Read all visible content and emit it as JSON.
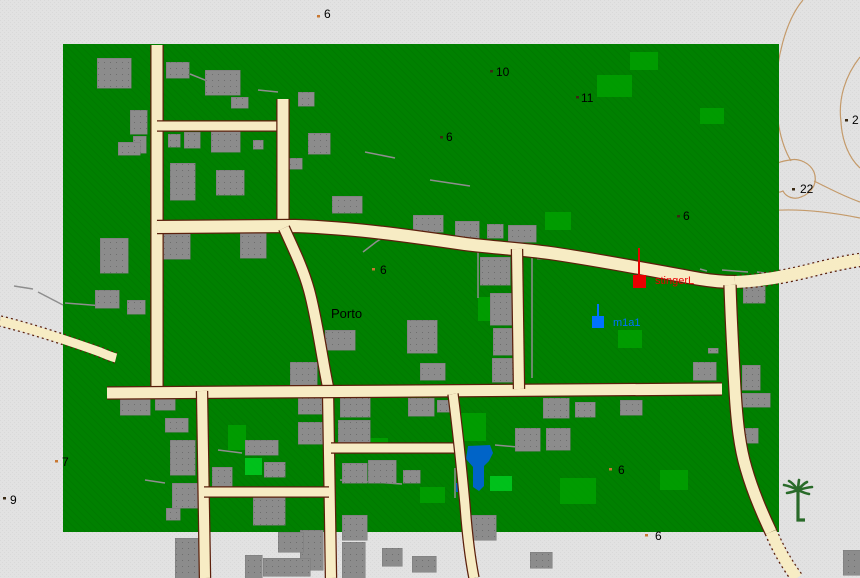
{
  "map": {
    "title": "editor-map-view",
    "outside_color": "#e2e2e2",
    "outside_dither": "#d9d9d9",
    "land_color": "#008000",
    "land_hatch": "#007a00",
    "land_rect": {
      "x": 63,
      "y": 44,
      "w": 716,
      "h": 488
    },
    "road_fill": "#f7ecc4",
    "road_edge": "#5c200c",
    "building_color": "#8c8c8c",
    "building_dot": "#6e6e6e",
    "contour_color": "#c49a6a",
    "water_color": "#0064c8",
    "fence_color": "#8e8e8e",
    "light_green": "#009e00",
    "bright_green": "#00c81e",
    "palm_color": "#2a6b2a",
    "dot_tan": "#c87832",
    "dot_dark": "#3a2a14"
  },
  "labels": [
    {
      "kind": "spot-height",
      "text": "6",
      "x": 324,
      "y": 18,
      "dot": {
        "x": 317,
        "y": 15,
        "c": "tan"
      }
    },
    {
      "kind": "spot-height",
      "text": "10",
      "x": 496,
      "y": 76,
      "dot": {
        "x": 490,
        "y": 70,
        "c": "dark"
      }
    },
    {
      "kind": "spot-height",
      "text": "11",
      "x": 581,
      "y": 102,
      "dot": {
        "x": 576,
        "y": 96,
        "c": "dark"
      }
    },
    {
      "kind": "spot-height",
      "text": "6",
      "x": 446,
      "y": 141,
      "dot": {
        "x": 440,
        "y": 136,
        "c": "dark"
      }
    },
    {
      "kind": "spot-height",
      "text": "6",
      "x": 683,
      "y": 220,
      "dot": {
        "x": 677,
        "y": 215,
        "c": "dark"
      }
    },
    {
      "kind": "spot-height",
      "text": "6",
      "x": 380,
      "y": 274,
      "dot": {
        "x": 372,
        "y": 268,
        "c": "tan"
      }
    },
    {
      "kind": "town",
      "text": "Porto",
      "x": 331,
      "y": 318
    },
    {
      "kind": "spot-height",
      "text": "2",
      "x": 852,
      "y": 124,
      "dot": {
        "x": 845,
        "y": 119,
        "c": "dark"
      }
    },
    {
      "kind": "spot-height",
      "text": "22",
      "x": 800,
      "y": 193,
      "dot": {
        "x": 792,
        "y": 188,
        "c": "dark"
      }
    },
    {
      "kind": "spot-height",
      "text": "7",
      "x": 62,
      "y": 466,
      "dot": {
        "x": 55,
        "y": 460,
        "c": "tan"
      }
    },
    {
      "kind": "spot-height",
      "text": "9",
      "x": 10,
      "y": 504,
      "dot": {
        "x": 3,
        "y": 497,
        "c": "dark"
      }
    },
    {
      "kind": "spot-height",
      "text": "6",
      "x": 618,
      "y": 474,
      "dot": {
        "x": 609,
        "y": 468,
        "c": "tan"
      }
    },
    {
      "kind": "spot-height",
      "text": "6",
      "x": 655,
      "y": 540,
      "dot": {
        "x": 645,
        "y": 534,
        "c": "tan"
      }
    }
  ],
  "markers": [
    {
      "name": "stingerL",
      "color": "#e80000",
      "square": {
        "x": 633,
        "y": 275,
        "w": 13,
        "h": 13
      },
      "line": {
        "x": 639,
        "y1": 248,
        "y2": 275
      },
      "text_x": 655,
      "text_y": 284
    },
    {
      "name": "m1a1",
      "color": "#0072ff",
      "square": {
        "x": 592,
        "y": 316,
        "w": 12,
        "h": 12
      },
      "line": {
        "x": 598,
        "y1": 304,
        "y2": 316
      },
      "text_x": 613,
      "text_y": 326
    }
  ],
  "roads": [
    {
      "name": "road-entry-west",
      "path": "M 0,321 C 30,328 75,343 100,352 C 107,355 112,357 116,358",
      "w": 9,
      "rural": true
    },
    {
      "name": "road-vertical-nw",
      "path": "M 157,45 L 157,392",
      "w": 11,
      "rural": false
    },
    {
      "name": "road-cross-upper",
      "path": "M 157,126 L 284,126",
      "w": 9,
      "rural": false
    },
    {
      "name": "road-vertical-n2",
      "path": "M 283,99 L 283,228",
      "w": 11,
      "rural": false
    },
    {
      "name": "road-main-upper",
      "path": "M 157,227 L 295,226 C 355,228 410,236 465,244 C 498,248 520,249 550,253 C 605,261 655,271 700,279 C 712,281 722,282 735,282",
      "w": 12,
      "rural": false
    },
    {
      "name": "road-main-upper-exit",
      "path": "M 735,282 C 762,281 788,276 812,270 C 828,266 845,262 860,260",
      "w": 12,
      "rural": true
    },
    {
      "name": "road-porto-curve",
      "path": "M 284,228 C 293,248 303,268 309,290 C 315,312 319,338 323,360 C 325,372 327,382 329,392",
      "w": 10,
      "rural": false
    },
    {
      "name": "road-vertical-center-south",
      "path": "M 328,390 L 331,578",
      "w": 10,
      "rural": false
    },
    {
      "name": "road-main-long",
      "path": "M 107,393 L 722,389",
      "w": 11,
      "rural": false
    },
    {
      "name": "road-vertical-sw",
      "path": "M 202,391 L 205,578",
      "w": 10,
      "rural": false
    },
    {
      "name": "road-vertical-mid",
      "path": "M 517,249 L 519,389",
      "w": 10,
      "rural": false
    },
    {
      "name": "road-cross-sw",
      "path": "M 204,492 L 329,492",
      "w": 9,
      "rural": false
    },
    {
      "name": "road-cross-south",
      "path": "M 331,448 L 456,448",
      "w": 9,
      "rural": false
    },
    {
      "name": "road-diag-south",
      "path": "M 453,394 C 457,425 461,462 465,505 C 467,532 470,558 474,578",
      "w": 9,
      "rural": false
    },
    {
      "name": "road-vertical-east",
      "path": "M 730,285 C 731,318 733,355 735,390 C 737,424 740,448 746,468 C 752,489 761,511 771,532",
      "w": 11,
      "rural": false
    },
    {
      "name": "road-east-exit",
      "path": "M 771,532 C 777,547 786,563 797,578",
      "w": 11,
      "rural": true
    }
  ],
  "contours": [
    {
      "name": "contour-ne-1",
      "path": "M 803,0 C 786,20 775,60 776,98 C 777,126 782,146 791,161"
    },
    {
      "name": "contour-ne-2",
      "path": "M 860,57 C 845,76 838,99 841,122 C 842,141 849,158 860,168"
    },
    {
      "name": "contour-loop-22",
      "path": "M 790,160 C 772,162 760,173 765,184 C 768,191 777,194 783,191 C 786,197 794,200 801,197 C 812,193 818,183 814,172 C 810,163 799,158 790,160 Z"
    },
    {
      "name": "contour-e-3",
      "path": "M 814,181 C 832,190 846,197 860,202"
    },
    {
      "name": "contour-e-4",
      "path": "M 766,211 C 796,208 830,212 860,218"
    },
    {
      "name": "contour-ring-11",
      "path": "M 566,99 C 568,89 580,84 591,85 C 601,86 605,93 602,101 C 598,109 584,113 574,110 C 566,108 564,104 566,99 Z"
    }
  ],
  "buildings": [
    [
      97,
      58,
      34,
      30
    ],
    [
      166,
      62,
      23,
      16
    ],
    [
      205,
      70,
      35,
      25
    ],
    [
      231,
      97,
      17,
      11
    ],
    [
      298,
      92,
      16,
      14
    ],
    [
      308,
      133,
      22,
      21
    ],
    [
      130,
      110,
      17,
      24
    ],
    [
      133,
      136,
      13,
      17
    ],
    [
      118,
      142,
      22,
      13
    ],
    [
      168,
      134,
      12,
      13
    ],
    [
      184,
      132,
      16,
      16
    ],
    [
      211,
      131,
      29,
      21
    ],
    [
      253,
      140,
      10,
      9
    ],
    [
      170,
      163,
      25,
      37
    ],
    [
      216,
      170,
      28,
      25
    ],
    [
      288,
      158,
      14,
      11
    ],
    [
      100,
      238,
      28,
      35
    ],
    [
      160,
      232,
      30,
      27
    ],
    [
      240,
      233,
      26,
      25
    ],
    [
      95,
      290,
      24,
      18
    ],
    [
      127,
      300,
      18,
      14
    ],
    [
      332,
      196,
      30,
      17
    ],
    [
      413,
      215,
      30,
      17
    ],
    [
      455,
      221,
      24,
      20
    ],
    [
      487,
      224,
      16,
      14
    ],
    [
      508,
      225,
      28,
      17
    ],
    [
      537,
      252,
      18,
      7
    ],
    [
      480,
      257,
      30,
      28
    ],
    [
      490,
      293,
      30,
      32
    ],
    [
      493,
      328,
      28,
      27
    ],
    [
      492,
      358,
      30,
      24
    ],
    [
      407,
      320,
      30,
      33
    ],
    [
      420,
      363,
      25,
      17
    ],
    [
      325,
      330,
      30,
      20
    ],
    [
      290,
      362,
      27,
      25
    ],
    [
      743,
      286,
      22,
      17
    ],
    [
      693,
      362,
      23,
      18
    ],
    [
      708,
      348,
      10,
      5
    ],
    [
      742,
      365,
      18,
      25
    ],
    [
      740,
      393,
      30,
      14
    ],
    [
      742,
      428,
      16,
      15
    ],
    [
      120,
      398,
      30,
      17
    ],
    [
      155,
      398,
      20,
      12
    ],
    [
      165,
      418,
      23,
      14
    ],
    [
      170,
      440,
      25,
      35
    ],
    [
      172,
      483,
      26,
      25
    ],
    [
      166,
      508,
      14,
      12
    ],
    [
      212,
      467,
      20,
      23
    ],
    [
      245,
      440,
      33,
      15
    ],
    [
      264,
      462,
      21,
      15
    ],
    [
      253,
      497,
      32,
      28
    ],
    [
      298,
      397,
      25,
      17
    ],
    [
      298,
      422,
      27,
      22
    ],
    [
      340,
      397,
      30,
      20
    ],
    [
      338,
      420,
      32,
      23
    ],
    [
      342,
      463,
      25,
      20
    ],
    [
      368,
      460,
      28,
      23
    ],
    [
      403,
      470,
      17,
      13
    ],
    [
      342,
      515,
      25,
      25
    ],
    [
      300,
      530,
      23,
      40
    ],
    [
      408,
      398,
      26,
      18
    ],
    [
      437,
      400,
      14,
      12
    ],
    [
      515,
      428,
      25,
      23
    ],
    [
      468,
      515,
      28,
      25
    ],
    [
      543,
      398,
      26,
      20
    ],
    [
      575,
      402,
      20,
      15
    ],
    [
      546,
      428,
      24,
      22
    ],
    [
      620,
      400,
      22,
      15
    ],
    [
      175,
      538,
      35,
      40
    ],
    [
      245,
      555,
      17,
      23
    ],
    [
      263,
      558,
      47,
      18
    ],
    [
      278,
      532,
      25,
      20
    ],
    [
      342,
      542,
      23,
      36
    ],
    [
      382,
      548,
      20,
      18
    ],
    [
      412,
      556,
      24,
      16
    ],
    [
      530,
      552,
      22,
      16
    ],
    [
      843,
      550,
      17,
      25
    ]
  ],
  "green_patches": [
    {
      "rect": [
        545,
        212,
        26,
        18
      ],
      "tone": "light"
    },
    {
      "rect": [
        597,
        75,
        35,
        22
      ],
      "tone": "light"
    },
    {
      "rect": [
        630,
        52,
        28,
        18
      ],
      "tone": "light"
    },
    {
      "rect": [
        700,
        108,
        24,
        16
      ],
      "tone": "light"
    },
    {
      "rect": [
        478,
        297,
        18,
        24
      ],
      "tone": "light"
    },
    {
      "rect": [
        618,
        330,
        24,
        18
      ],
      "tone": "light"
    },
    {
      "rect": [
        460,
        413,
        26,
        28
      ],
      "tone": "light"
    },
    {
      "rect": [
        228,
        425,
        18,
        25
      ],
      "tone": "light"
    },
    {
      "rect": [
        368,
        438,
        20,
        16
      ],
      "tone": "light"
    },
    {
      "rect": [
        660,
        470,
        28,
        20
      ],
      "tone": "light"
    },
    {
      "rect": [
        560,
        478,
        36,
        26
      ],
      "tone": "light"
    },
    {
      "rect": [
        420,
        487,
        25,
        16
      ],
      "tone": "light"
    },
    {
      "rect": [
        245,
        458,
        17,
        17
      ],
      "tone": "bright"
    },
    {
      "rect": [
        490,
        476,
        22,
        15
      ],
      "tone": "bright"
    }
  ],
  "fences": [
    {
      "points": "14,286 33,289"
    },
    {
      "points": "38,292 63,305"
    },
    {
      "points": "65,303 117,307"
    },
    {
      "points": "700,269 707,271"
    },
    {
      "points": "722,270 748,272"
    },
    {
      "points": "757,272 772,274"
    },
    {
      "points": "398,228 376,242 363,252"
    },
    {
      "points": "478,250 478,298"
    },
    {
      "points": "532,258 532,378"
    },
    {
      "points": "190,74 205,80 222,90 240,93"
    },
    {
      "points": "258,90 278,92"
    },
    {
      "points": "430,180 470,186"
    },
    {
      "points": "365,152 395,158"
    },
    {
      "points": "495,445 528,448"
    },
    {
      "points": "455,468 455,498"
    },
    {
      "points": "340,480 402,484"
    },
    {
      "points": "218,450 242,453"
    },
    {
      "points": "145,480 165,483"
    }
  ],
  "water": {
    "pond_path": "M 468,446 L 490,445 L 493,453 L 489,461 L 484,466 L 484,486 L 479,491 L 473,487 L 473,467 L 466,459 Z",
    "small_rect": [
      456,
      483,
      4,
      9
    ]
  },
  "palm": {
    "x": 798,
    "y": 490
  }
}
